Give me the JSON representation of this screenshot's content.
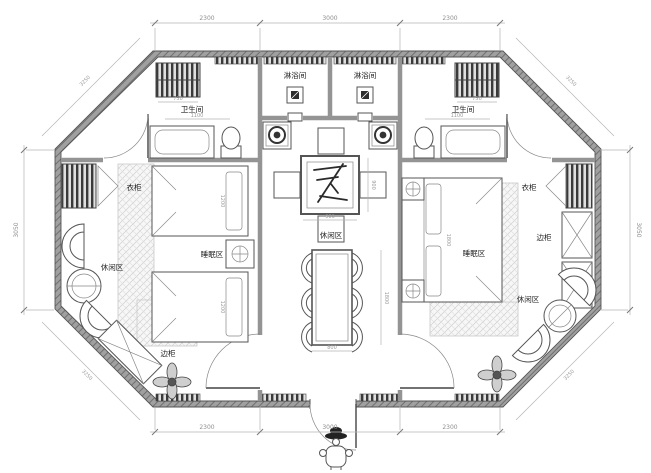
{
  "labels": {
    "shower_left": "淋浴间",
    "shower_right": "淋浴间",
    "bathroom_left": "卫生间",
    "bathroom_right": "卫生间",
    "wardrobe_left": "衣柜",
    "wardrobe_right": "衣柜",
    "leisure_left": "休闲区",
    "leisure_center": "休闲区",
    "leisure_right": "休闲区",
    "sleeping_left": "睡眠区",
    "sleeping_right": "睡眠区",
    "cabinet_left": "边柜",
    "cabinet_right": "边柜"
  },
  "dimensions": {
    "top": [
      "2300",
      "3000",
      "2300"
    ],
    "bottom": [
      "2300",
      "3000",
      "2300"
    ],
    "left": "3050",
    "right": "3050",
    "diagonal": "3250",
    "towel_rack": "750",
    "bath": "1100",
    "tea_table_w": "900",
    "tea_table_h": "900",
    "dining_w": "800",
    "dining_h": "1800",
    "bed_single": "1200",
    "bed_double": "1800"
  },
  "colors": {
    "paper": "#ffffff",
    "wall": "#a0a0a0",
    "wall_hatch": "#707070",
    "line": "#555555",
    "dim": "#8f8f8f"
  }
}
